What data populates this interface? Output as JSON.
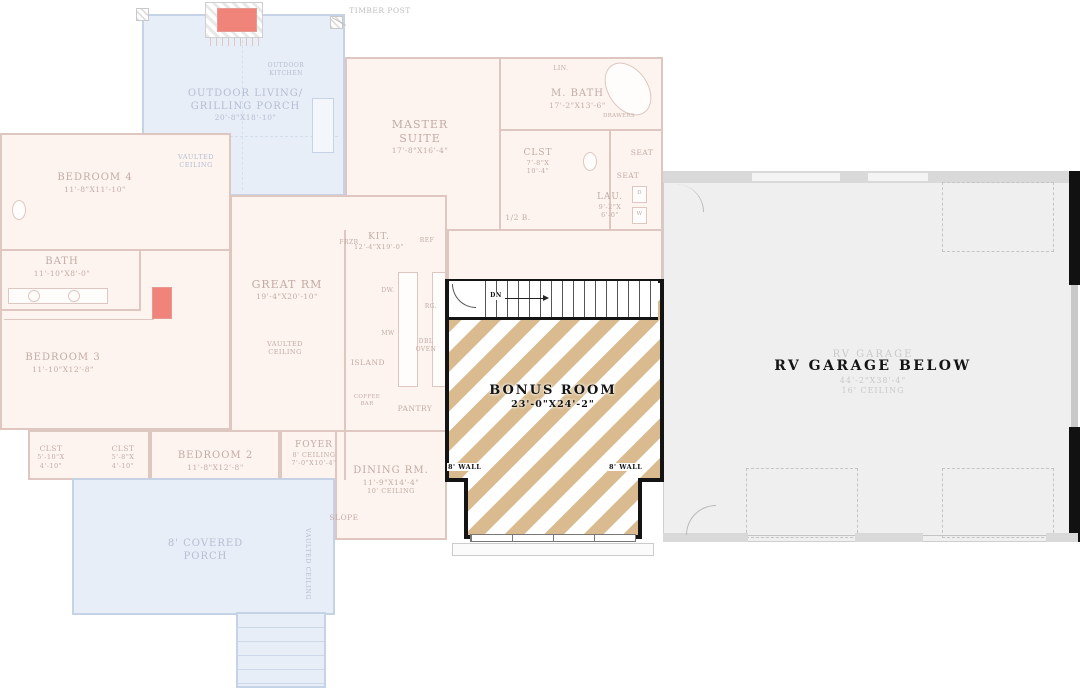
{
  "colors": {
    "bonus_stripe_tan": "#d9bb8f",
    "faded_plan_line": "#ddc7c0",
    "porch_blue_line": "#c6d2e5",
    "garage_fill": "#f0efef",
    "accent_red": "#f0837a",
    "ink": "#141414"
  },
  "annotations": {
    "timber_post": "TIMBER POST",
    "dn": "DN",
    "wall_left": "8' WALL",
    "wall_right": "8' WALL"
  },
  "bonus_room": {
    "name": "BONUS ROOM",
    "dims": "23'-0\"X24'-2\""
  },
  "garage": {
    "title": "RV GARAGE BELOW",
    "ghost_name": "RV GARAGE",
    "ghost_dims": "44'-2\"X38'-4\"",
    "ghost_ceiling": "16' CEILING"
  },
  "rooms": {
    "outdoor_living": {
      "l1": "OUTDOOR LIVING/",
      "l2": "GRILLING PORCH",
      "dims": "20'-8\"X18'-10\""
    },
    "outdoor_kitchen": {
      "l1": "OUTDOOR",
      "l2": "KITCHEN"
    },
    "porch_vaulted": {
      "l1": "VAULTED",
      "l2": "CEILING"
    },
    "master_suite": {
      "l1": "MASTER",
      "l2": "SUITE",
      "dims": "17'-8\"X16'-4\""
    },
    "m_bath": {
      "l1": "M. BATH",
      "dims": "17'-2\"X13'-6\""
    },
    "lin": {
      "l1": "LIN."
    },
    "m_clst": {
      "l1": "CLST",
      "d1": "7'-8\"X",
      "d2": "10'-4\""
    },
    "drawers": {
      "l1": "DRAWERS"
    },
    "seat_a": {
      "l1": "SEAT"
    },
    "seat_b": {
      "l1": "SEAT"
    },
    "lau": {
      "l1": "LAU.",
      "d1": "9'-2\"X",
      "d2": "6'-0\""
    },
    "half_bath": {
      "l1": "1/2 B."
    },
    "washer": {
      "l1": "W"
    },
    "dryer": {
      "l1": "D"
    },
    "bedroom4": {
      "l1": "BEDROOM 4",
      "dims": "11'-8\"X11'-10\""
    },
    "bath": {
      "l1": "BATH",
      "dims": "11'-10\"X8'-0\""
    },
    "bedroom3": {
      "l1": "BEDROOM 3",
      "dims": "11'-10\"X12'-8\""
    },
    "great_rm": {
      "l1": "GREAT RM",
      "dims": "19'-4\"X20'-10\""
    },
    "great_vaulted": {
      "l1": "VAULTED",
      "l2": "CEILING"
    },
    "kit": {
      "l1": "KIT.",
      "dims": "12'-4\"X19'-0\""
    },
    "frzr": {
      "l1": "FRZR"
    },
    "ref": {
      "l1": "REF"
    },
    "dw": {
      "l1": "DW."
    },
    "mw": {
      "l1": "MW"
    },
    "rg": {
      "l1": "RG."
    },
    "dbl_oven": {
      "l1": "DBL",
      "l2": "OVEN"
    },
    "island": {
      "l1": "ISLAND"
    },
    "coffee_bar": {
      "l1": "COFFEE",
      "l2": "BAR"
    },
    "pantry": {
      "l1": "PANTRY"
    },
    "clst_a": {
      "l1": "CLST",
      "d1": "5'-10\"X",
      "d2": "4'-10\""
    },
    "clst_b": {
      "l1": "CLST",
      "d1": "5'-8\"X",
      "d2": "4'-10\""
    },
    "bedroom2": {
      "l1": "BEDROOM 2",
      "dims": "11'-8\"X12'-8\""
    },
    "foyer": {
      "l1": "FOYER",
      "l2": "8' CEILING",
      "dims": "7'-0\"X10'-4\""
    },
    "dining": {
      "l1": "DINING RM.",
      "dims": "11'-9\"X14'-4\"",
      "l3": "10' CEILING"
    },
    "slope": {
      "l1": "SLOPE"
    },
    "covered_porch": {
      "l1": "8'  COVERED",
      "l2": "PORCH"
    },
    "side_vaulted": {
      "l1": "VAULTED CEILING"
    }
  }
}
